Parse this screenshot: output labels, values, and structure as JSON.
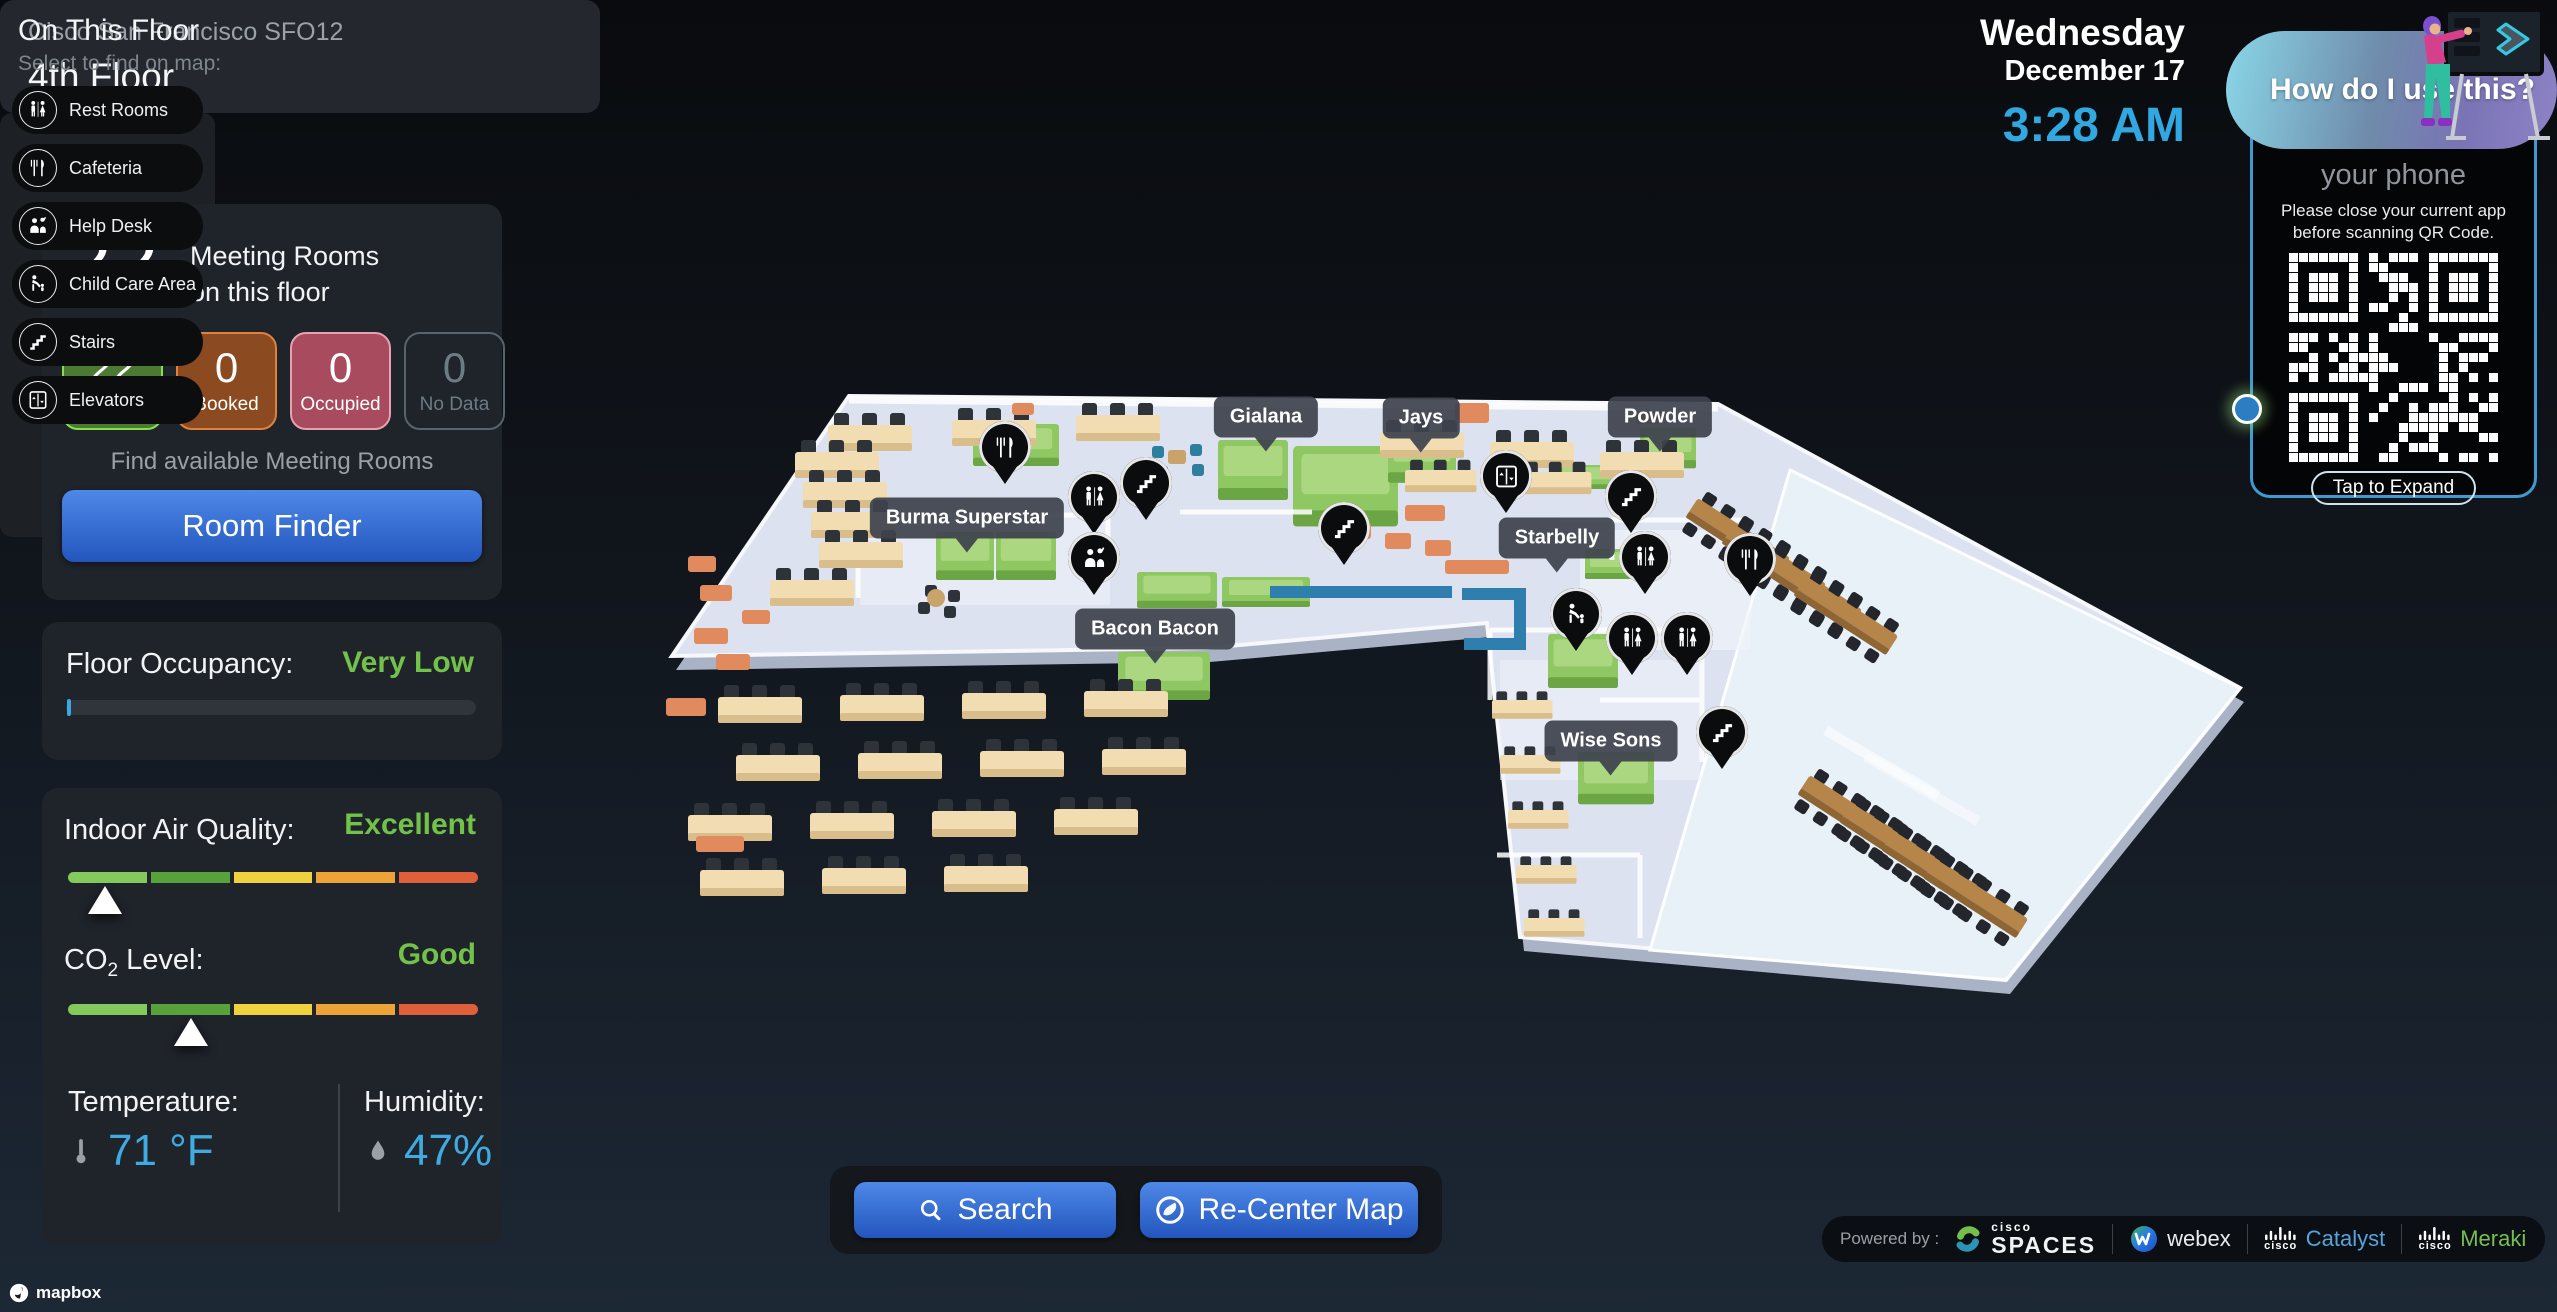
{
  "header": {
    "building": "Cisco San Francisco SFO12",
    "floor": "4th Floor"
  },
  "datetime": {
    "day": "Wednesday",
    "date": "December 17",
    "time": "3:28 AM",
    "time_color": "#31a8e0"
  },
  "help_pill": {
    "text": "How do I use this?"
  },
  "qr_panel": {
    "heading": "your phone",
    "instruction_line1": "Please close your current app",
    "instruction_line2": "before scanning QR Code.",
    "expand_label": "Tap to Expand",
    "border_color": "#3f9ad2"
  },
  "meeting_rooms": {
    "count": "22",
    "title_line1": "Meeting Rooms",
    "title_line2": "on this floor",
    "stats": [
      {
        "value": "22",
        "label": "Available",
        "bg": "#4c7a33",
        "border": "#86df4c",
        "text": "#ffffff"
      },
      {
        "value": "0",
        "label": "Booked",
        "bg": "#8c4a20",
        "border": "#df823f",
        "text": "#ffffff"
      },
      {
        "value": "0",
        "label": "Occupied",
        "bg": "#a84b5e",
        "border": "#e5a2b0",
        "text": "#ffffff"
      },
      {
        "value": "0",
        "label": "No Data",
        "bg": "transparent",
        "border": "#57646d",
        "text": "#6d7b85"
      }
    ],
    "hint": "Find available Meeting Rooms",
    "button": "Room Finder"
  },
  "occupancy": {
    "label": "Floor Occupancy:",
    "value": "Very Low",
    "value_color": "#72c24a",
    "progress_percent": 1
  },
  "environment": {
    "iaq_label": "Indoor Air Quality:",
    "iaq_value": "Excellent",
    "iaq_percent": 9,
    "co2_prefix": "CO",
    "co2_sub": "2",
    "co2_suffix": " Level:",
    "co2_value": "Good",
    "co2_percent": 30,
    "status_color": "#72c24a",
    "scale_colors": [
      "#84c95c",
      "#58a23c",
      "#f0d23e",
      "#eca438",
      "#e05f3b"
    ],
    "temp_label": "Temperature:",
    "temp_value": "71 °F",
    "humidity_label": "Humidity:",
    "humidity_value": "47%",
    "reading_color": "#3fabe1"
  },
  "on_this_floor": {
    "title": "On This Floor",
    "subtitle": "Select to find on map:",
    "items": [
      {
        "icon": "restroom",
        "label": "Rest Rooms"
      },
      {
        "icon": "cafeteria",
        "label": "Cafeteria"
      },
      {
        "icon": "helpdesk",
        "label": "Help Desk"
      },
      {
        "icon": "childcare",
        "label": "Child Care Area"
      },
      {
        "icon": "stairs",
        "label": "Stairs"
      },
      {
        "icon": "elevator",
        "label": "Elevators"
      }
    ]
  },
  "map": {
    "labels": [
      {
        "text": "Gialana",
        "x": 1266,
        "y": 417
      },
      {
        "text": "Jays",
        "x": 1421,
        "y": 418
      },
      {
        "text": "Powder",
        "x": 1660,
        "y": 417
      },
      {
        "text": "Burma Superstar",
        "x": 967,
        "y": 518
      },
      {
        "text": "Starbelly",
        "x": 1557,
        "y": 538
      },
      {
        "text": "Bacon Bacon",
        "x": 1155,
        "y": 629
      },
      {
        "text": "Wise Sons",
        "x": 1611,
        "y": 741
      }
    ],
    "pins": [
      {
        "type": "cafeteria",
        "x": 1005,
        "y": 447
      },
      {
        "type": "restroom",
        "x": 1094,
        "y": 497
      },
      {
        "type": "stairs",
        "x": 1146,
        "y": 483
      },
      {
        "type": "helpdesk",
        "x": 1094,
        "y": 558
      },
      {
        "type": "stairs",
        "x": 1344,
        "y": 528
      },
      {
        "type": "elevator",
        "x": 1506,
        "y": 476
      },
      {
        "type": "stairs",
        "x": 1631,
        "y": 496
      },
      {
        "type": "restroom",
        "x": 1645,
        "y": 557
      },
      {
        "type": "cafeteria",
        "x": 1750,
        "y": 559
      },
      {
        "type": "childcare",
        "x": 1576,
        "y": 614
      },
      {
        "type": "restroom",
        "x": 1632,
        "y": 638
      },
      {
        "type": "restroom",
        "x": 1687,
        "y": 638
      },
      {
        "type": "stairs",
        "x": 1722,
        "y": 732
      }
    ]
  },
  "actions": {
    "search": "Search",
    "recenter": "Re-Center Map"
  },
  "powered": {
    "label": "Powered by :",
    "brands": [
      {
        "type": "spaces",
        "prefix": "cisco",
        "name": "SPACES"
      },
      {
        "type": "webex",
        "name": "webex"
      },
      {
        "type": "cisco",
        "prefix": "cisco",
        "name": "Catalyst",
        "color": "#55a5dc"
      },
      {
        "type": "cisco",
        "prefix": "cisco",
        "name": "Meraki",
        "color": "#76bf55"
      }
    ]
  },
  "attribution": {
    "mapbox": "mapbox"
  }
}
